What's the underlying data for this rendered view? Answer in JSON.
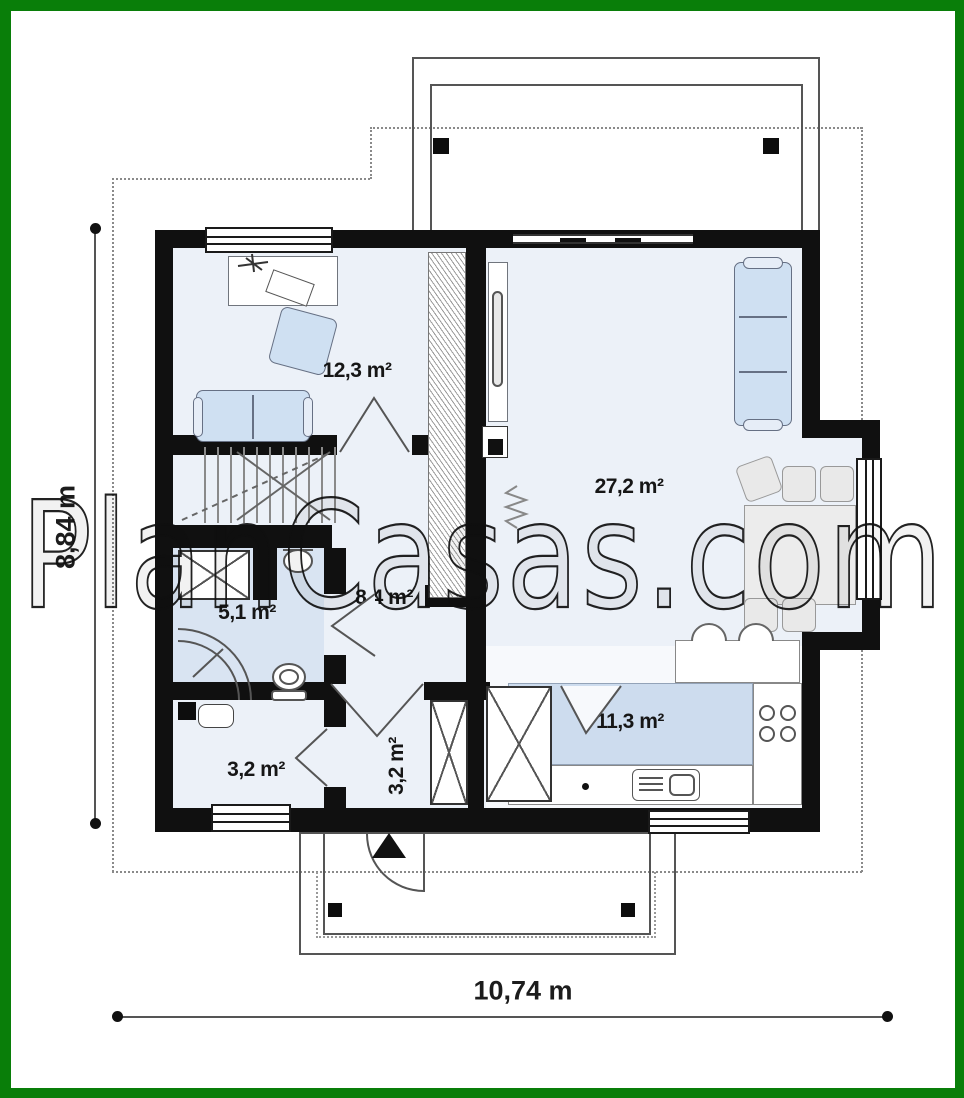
{
  "watermark": {
    "text": "PlanCasas.com"
  },
  "dimensions": {
    "height_label": "8,84 m",
    "width_label": "10,74 m"
  },
  "rooms": [
    {
      "id": "bedroom",
      "area_label": "12,3 m²"
    },
    {
      "id": "living-room",
      "area_label": "27,2 m²"
    },
    {
      "id": "hall",
      "area_label": "8,4 m²"
    },
    {
      "id": "bathroom",
      "area_label": "5,1 m²"
    },
    {
      "id": "utility",
      "area_label": "3,2 m²"
    },
    {
      "id": "entry",
      "area_label": "3,2 m²"
    },
    {
      "id": "kitchen",
      "area_label": "11,3 m²"
    }
  ],
  "fixtures": [
    "terrace-posts",
    "porch-posts",
    "stairs",
    "wardrobe",
    "sofa",
    "armchair",
    "desk",
    "dining-table",
    "chairs",
    "bar-stools",
    "kitchen-counter",
    "stove",
    "sink",
    "fridge-cabinet",
    "washing-machine",
    "corner-shower",
    "toilet",
    "washbasin",
    "radiator",
    "entrance-door-arrow",
    "bay-window"
  ],
  "colors": {
    "frame_green": "#097e09",
    "wall_black": "#101010",
    "floor_tint": "#ecf1f8",
    "bathroom_tint": "#d9e4f2",
    "kitchen_counter_blue": "#cddcee",
    "furniture_blue": "#cfe0f2"
  }
}
